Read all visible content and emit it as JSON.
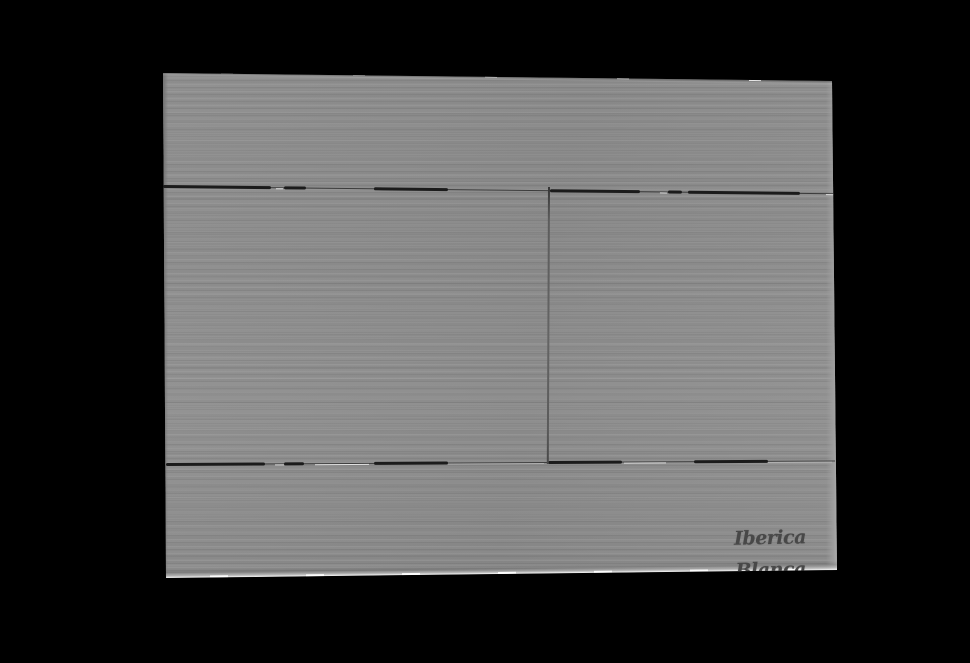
{
  "scene": {
    "background_color": "#000000",
    "description": "Product photo of a brushed gun-metal grey dual-flush toilet actuator wall plate shown at a slight perspective angle on a black background"
  },
  "plate": {
    "brand_label": "Iberica Blanca",
    "finish": "brushed gun-metal grey",
    "buttons": {
      "left_label": "large flush button",
      "right_label": "small flush button"
    },
    "colors": {
      "face": "#8e8e8e",
      "groove": "#1b1b1b",
      "divider": "#5c5c5c",
      "edge_shadow": "#5e5e5e",
      "edge_highlight": "#b0b0b0",
      "logo_text": "#484848"
    }
  }
}
